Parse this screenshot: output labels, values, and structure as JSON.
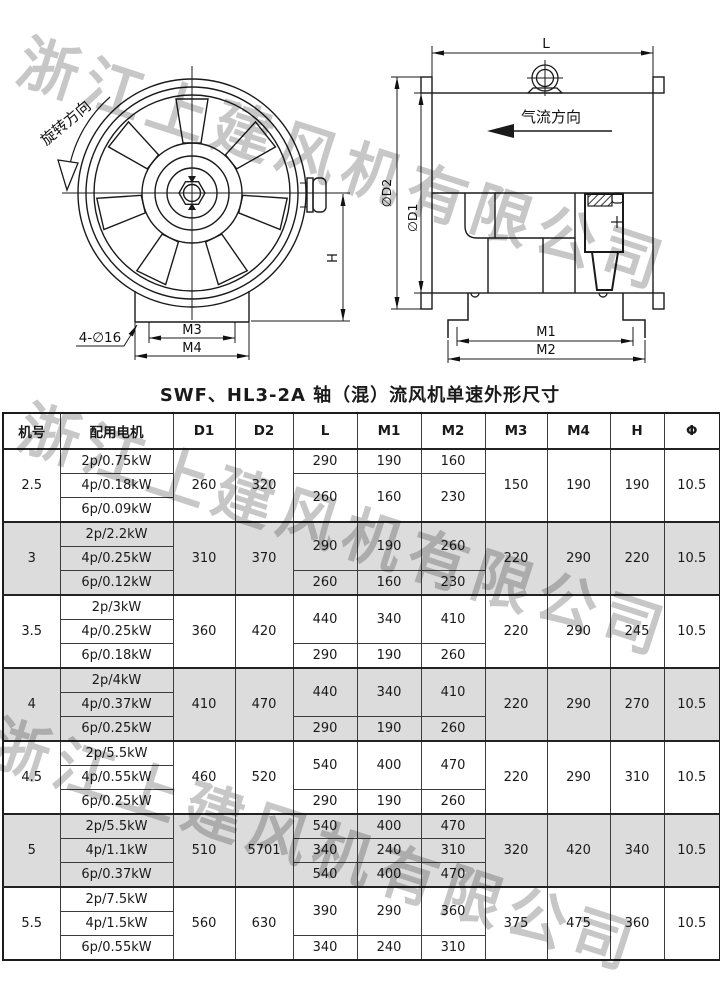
{
  "watermark": {
    "text": "浙江上建风机有限公司",
    "color": "#c7c7c7"
  },
  "title": "SWF、HL3-2A 轴（混）流风机单速外形尺寸",
  "drawings": {
    "front": {
      "rotation": "旋转方向",
      "bolt": "4-∅16",
      "m3": "M3",
      "m4": "M4",
      "h": "H"
    },
    "side": {
      "l": "L",
      "airflow": "气流方向",
      "d2": "∅D2",
      "d1": "∅D1",
      "m1": "M1",
      "m2": "M2"
    }
  },
  "table": {
    "headers": [
      "机号",
      "配用电机",
      "D1",
      "D2",
      "L",
      "M1",
      "M2",
      "M3",
      "M4",
      "H",
      "Φ"
    ],
    "groups": [
      {
        "size": "2.5",
        "shaded": false,
        "motors": [
          "2p/0.75kW",
          "4p/0.18kW",
          "6p/0.09kW"
        ],
        "d1": "260",
        "d2": "320",
        "lm": [
          {
            "span": 1,
            "l": "290",
            "m1": "190",
            "m2": "160"
          },
          {
            "span": 2,
            "l": "260",
            "m1": "160",
            "m2": "230"
          }
        ],
        "m3": "150",
        "m4": "190",
        "h": "190",
        "phi": "10.5"
      },
      {
        "size": "3",
        "shaded": true,
        "motors": [
          "2p/2.2kW",
          "4p/0.25kW",
          "6p/0.12kW"
        ],
        "d1": "310",
        "d2": "370",
        "lm": [
          {
            "span": 2,
            "l": "290",
            "m1": "190",
            "m2": "260"
          },
          {
            "span": 1,
            "l": "260",
            "m1": "160",
            "m2": "230"
          }
        ],
        "m3": "220",
        "m4": "290",
        "h": "220",
        "phi": "10.5"
      },
      {
        "size": "3.5",
        "shaded": false,
        "motors": [
          "2p/3kW",
          "4p/0.25kW",
          "6p/0.18kW"
        ],
        "d1": "360",
        "d2": "420",
        "lm": [
          {
            "span": 2,
            "l": "440",
            "m1": "340",
            "m2": "410"
          },
          {
            "span": 1,
            "l": "290",
            "m1": "190",
            "m2": "260"
          }
        ],
        "m3": "220",
        "m4": "290",
        "h": "245",
        "phi": "10.5"
      },
      {
        "size": "4",
        "shaded": true,
        "motors": [
          "2p/4kW",
          "4p/0.37kW",
          "6p/0.25kW"
        ],
        "d1": "410",
        "d2": "470",
        "lm": [
          {
            "span": 2,
            "l": "440",
            "m1": "340",
            "m2": "410"
          },
          {
            "span": 1,
            "l": "290",
            "m1": "190",
            "m2": "260"
          }
        ],
        "m3": "220",
        "m4": "290",
        "h": "270",
        "phi": "10.5"
      },
      {
        "size": "4.5",
        "shaded": false,
        "motors": [
          "2p/5.5kW",
          "4p/0.55kW",
          "6p/0.25kW"
        ],
        "d1": "460",
        "d2": "520",
        "lm": [
          {
            "span": 2,
            "l": "540",
            "m1": "400",
            "m2": "470"
          },
          {
            "span": 1,
            "l": "290",
            "m1": "190",
            "m2": "260"
          }
        ],
        "m3": "220",
        "m4": "290",
        "h": "310",
        "phi": "10.5"
      },
      {
        "size": "5",
        "shaded": true,
        "motors": [
          "2p/5.5kW",
          "4p/1.1kW",
          "6p/0.37kW"
        ],
        "d1": "510",
        "d2": "5701",
        "lm": [
          {
            "span": 1,
            "l": "540",
            "m1": "400",
            "m2": "470"
          },
          {
            "span": 1,
            "l": "340",
            "m1": "240",
            "m2": "310"
          },
          {
            "span": 1,
            "l": "540",
            "m1": "400",
            "m2": "470"
          }
        ],
        "m3": "320",
        "m4": "420",
        "h": "340",
        "phi": "10.5"
      },
      {
        "size": "5.5",
        "shaded": false,
        "motors": [
          "2p/7.5kW",
          "4p/1.5kW",
          "6p/0.55kW"
        ],
        "d1": "560",
        "d2": "630",
        "lm": [
          {
            "span": 2,
            "l": "390",
            "m1": "290",
            "m2": "360"
          },
          {
            "span": 1,
            "l": "340",
            "m1": "240",
            "m2": "310"
          }
        ],
        "m3": "375",
        "m4": "475",
        "h": "360",
        "phi": "10.5"
      }
    ]
  }
}
